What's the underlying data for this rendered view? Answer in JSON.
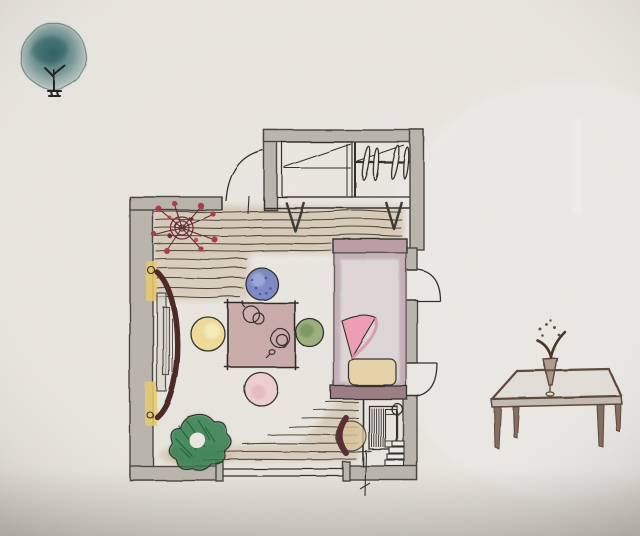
{
  "scene": {
    "type": "hand-drawn interior floor plan sketch",
    "medium": "ink and watercolor on textured paper",
    "description": "Watercolor floor-plan sketch of a small bedroom: plank wood floor, low square tea table with four round floor cushions (blue, yellow, green, pink), bed with folded pink blanket and pillow, top closet with clothes hangers, bookshelf nook with clock and stacked books, leafy plant, red berry arrangement; a small watercolor tree doodle at top-left and a low wooden side table with a flower vase sketched at right"
  },
  "palette": {
    "paper": "#e9e6e0",
    "papershade": "#d8d4cd",
    "ink": "#35322e",
    "wall": "#b9b5ad",
    "wallline": "#4a4741",
    "wood": "#c3ae92",
    "woodline": "#453826",
    "tablefill": "#c4a1a1",
    "bedframe": "#bb9da4",
    "bedfill": "#dcd4d5",
    "bedborder": "#b096a0",
    "bedfold": "#ec9fb4",
    "bedfold2": "#d8909f",
    "pillowc": "#e4d3a9",
    "footboard": "#9c7e85",
    "blue": "#7381c1",
    "bluedark": "#4d5ca8",
    "yellowc": "#edd992",
    "green": "#95aa74",
    "greendark": "#66854c",
    "pink": "#eccbd0",
    "treefill": "#4e7b7c",
    "treedark": "#2f5f63",
    "treeedge": "#6e7f7b",
    "plantg": "#2e7d4b",
    "plantdark": "#175c33",
    "flower": "#ab3a4e",
    "flowerdark": "#6f2d38",
    "doorbrown": "#4e2b28",
    "accent": "#e9c96d",
    "sepia": "#5f483c",
    "sepiadark": "#4a362c"
  },
  "objects": {
    "tree": {
      "label": "watercolor tree"
    },
    "room": {
      "label": "main room"
    },
    "closet": {
      "label": "closet with clothes hangers"
    },
    "entry_door": {
      "label": "curved entry door on left wall"
    },
    "top_door": {
      "label": "door swing at top wall opening"
    },
    "right_doors": {
      "label": "two door swings on right wall"
    },
    "window": {
      "label": "window along bottom wall"
    },
    "wood_floor": {
      "label": "plank wood flooring"
    },
    "flowers": {
      "label": "red berry arrangement"
    },
    "low_table": {
      "label": "low square tea table"
    },
    "tea_set": {
      "label": "teapot and cup on table"
    },
    "cushion_blue": {
      "label": "blue floor cushion"
    },
    "cushion_yellow": {
      "label": "yellow floor cushion"
    },
    "cushion_green": {
      "label": "green floor cushion"
    },
    "cushion_pink": {
      "label": "pink floor cushion"
    },
    "bed": {
      "label": "bed with folded blanket and pillow"
    },
    "nook": {
      "label": "nook with bookshelf, clock, stacked books"
    },
    "floor_chair": {
      "label": "round floor chair at foot of bed"
    },
    "plant": {
      "label": "leafy green plant"
    },
    "dimension": {
      "label": "dimension tick on bottom wall"
    },
    "side_table": {
      "label": "low wooden side table with flower vase"
    }
  }
}
